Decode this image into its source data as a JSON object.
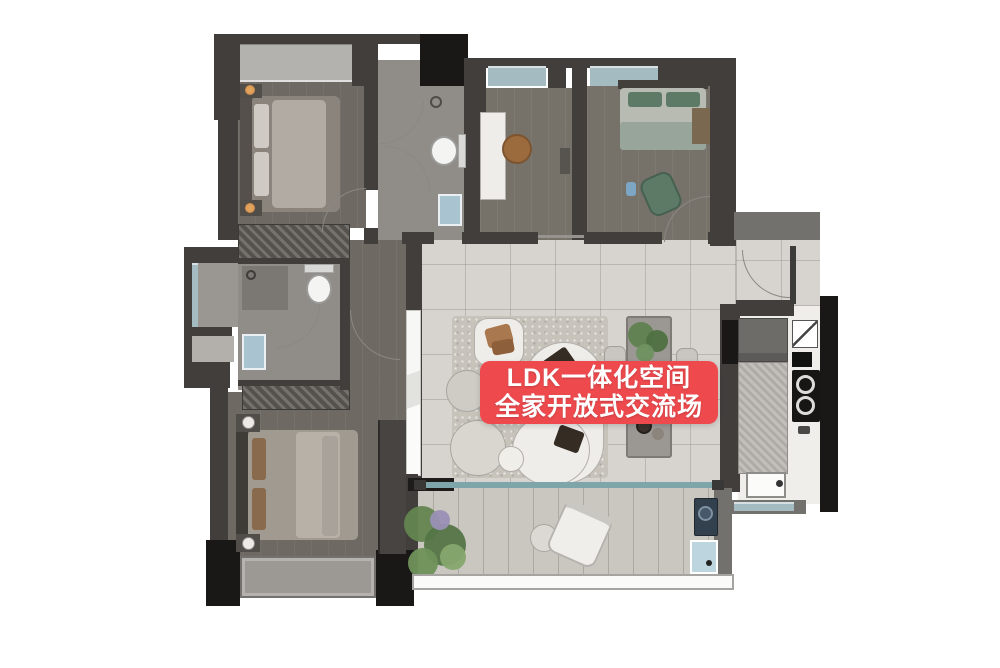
{
  "banner": {
    "line1": "LDK一体化空间",
    "line2": "全家开放式交流场"
  },
  "colors": {
    "background": "#ffffff",
    "banner_bg": "#ee4a4e",
    "banner_text": "#ffffff",
    "wall_dark": "#413e3c",
    "wall_black": "#191817",
    "wall_medium": "#73716e",
    "wood_floor": "#6e6963",
    "wood_floor_light": "#777269",
    "tile_floor": "#d7d4cf",
    "bath_floor": "#908c87",
    "kitchen_floor": "#efeeeb",
    "balcony_floor": "#cac7c1",
    "rug": "#c7c3bb",
    "window_glass": "#a4bbc2",
    "bay_glass": "#b4b2ae",
    "plant_green": "#5d7f4e",
    "furniture_white": "#efede9",
    "sofa_cushion": "#352c24",
    "sink_blue": "#a9c3d1",
    "track_teal": "#7ea5aa"
  }
}
